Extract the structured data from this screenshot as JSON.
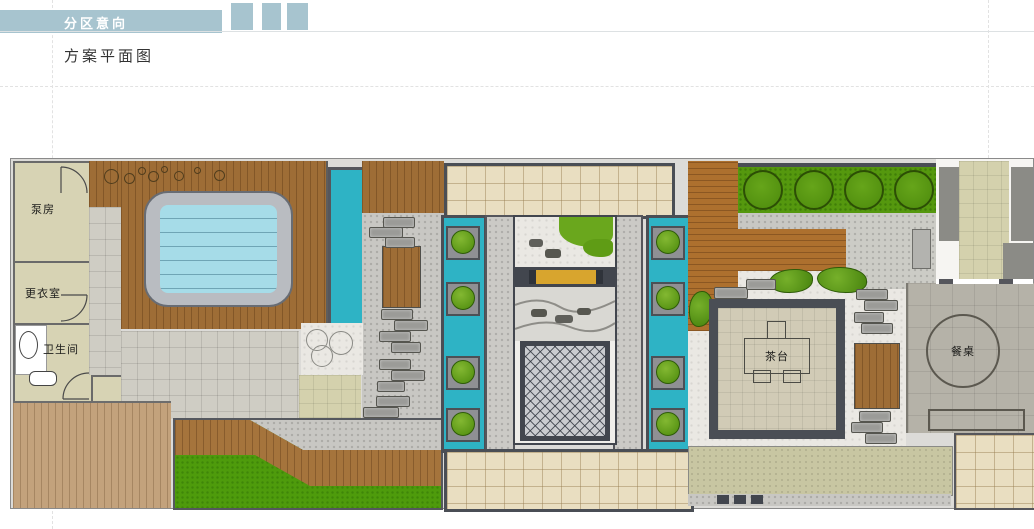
{
  "header": {
    "section_title": "分区意向",
    "decor_square_count": 3
  },
  "page": {
    "title": "方案平面图"
  },
  "plan": {
    "labels": {
      "pump_room": "泵房",
      "changing_room": "更衣室",
      "toilet": "卫生间",
      "tea_table": "茶台",
      "dining_table": "餐桌"
    }
  },
  "colors": {
    "accent_bar": "#a7c4cf",
    "water_channel": "#2eb3c5",
    "hot_tub_water": "#a6dce8",
    "lawn": "#4e9b0c",
    "hedge": "#55980e",
    "shrub": "#5da015",
    "wood_dark": "#9e6d36",
    "wood_light": "#c3a27c",
    "wood_orange": "#ad702e",
    "tile_beige": "#e9dec1",
    "bench_yellow": "#d8a52e",
    "frame_dark": "#42464e",
    "pavement_gray": "#b5b2a8"
  }
}
